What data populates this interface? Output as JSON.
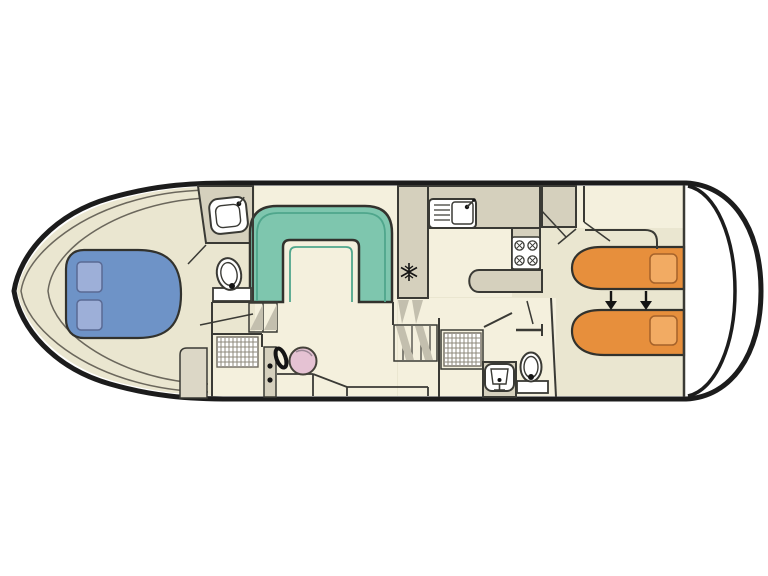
{
  "meta": {
    "title": "Houseboat deck floor plan",
    "type": "boat-floor-plan"
  },
  "colors": {
    "background": "#ffffff",
    "hull_outline": "#1c1c1c",
    "wall": "#3a3a35",
    "outline_dark": "#32322d",
    "icon_dark": "#141414",
    "floor_main": "#eae6d0",
    "floor_light": "#f4f0dd",
    "surface_gray": "#d5d0bd",
    "panel_gray": "#dcd7c6",
    "dinette": "#7ec6ae",
    "dinette_inner": "#4fa68c",
    "bed_double": "#6e93c7",
    "bed_double_pillow": "#9dafd8",
    "pillow_outline_blue": "#5a6a94",
    "bed_single": "#e78f3c",
    "bed_single_pillow": "#f2ab63",
    "pillow_outline_orange": "#a5622a",
    "helm_seat": "#e5c2d3",
    "seat_outline": "#44413a",
    "grate_line": "#8d897b",
    "grate_border": "#6e6a5e",
    "fixture": "#ffffff",
    "shading": "#c3bfae",
    "arrow": "#141414"
  },
  "rooms": [
    "bow-cabin-double",
    "forward-bathroom",
    "forward-shower",
    "saloon-dinette",
    "helm-station",
    "galley",
    "aft-corridor",
    "aft-bathroom",
    "aft-cabin-twin",
    "stern-deck"
  ],
  "icons": [
    "double-bed",
    "pillow",
    "u-shaped-dinette-bench",
    "washbasin",
    "toilet",
    "shower-grate",
    "companionway-steps",
    "steering-wheel",
    "helm-seat",
    "kitchen-sink-drainer",
    "stove-4-burners",
    "fridge-snowflake",
    "wardrobe",
    "staircase",
    "single-bed",
    "bed-slide-arrow",
    "stern-rail"
  ]
}
